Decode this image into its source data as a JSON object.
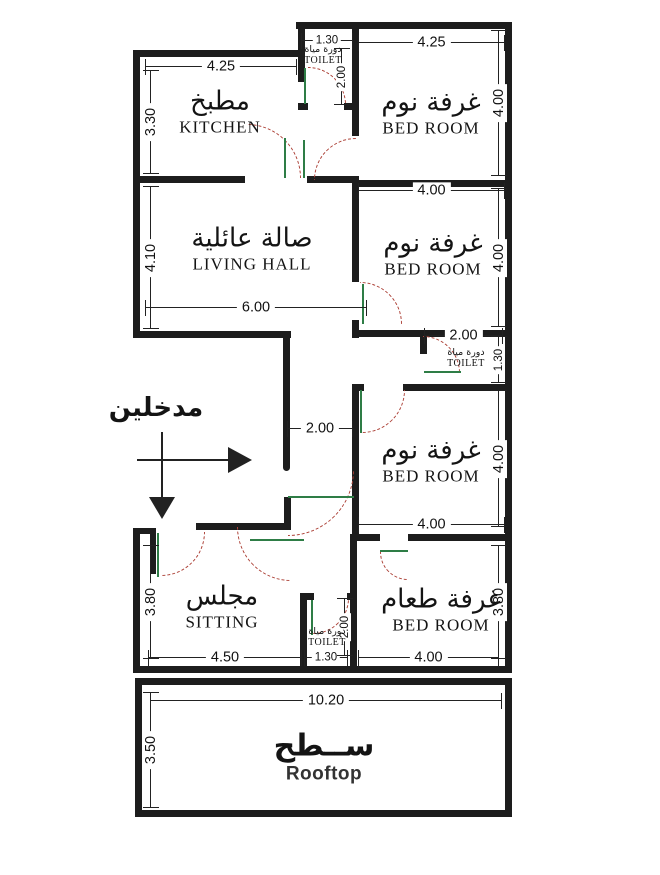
{
  "rooms": {
    "kitchen": {
      "ar": "مطبخ",
      "en": "KITCHEN"
    },
    "bedroom1": {
      "ar": "غرفة نوم",
      "en": "BED ROOM"
    },
    "toilet1": {
      "ar": "دورة مياة",
      "en": "TOILET"
    },
    "living": {
      "ar": "صالة عائلية",
      "en": "LIVING HALL"
    },
    "bedroom2": {
      "ar": "غرفة نوم",
      "en": "BED ROOM"
    },
    "toilet2": {
      "ar": "دورة مياة",
      "en": "TOILET"
    },
    "bedroom3": {
      "ar": "غرفة نوم",
      "en": "BED ROOM"
    },
    "sitting": {
      "ar": "مجلس",
      "en": "SITTING"
    },
    "toilet3": {
      "ar": "دورة مياة",
      "en": "TOILET"
    },
    "dining": {
      "ar": "غرفة طعام",
      "en": "BED ROOM"
    },
    "rooftop": {
      "ar": "ســطح",
      "en": "Rooftop"
    }
  },
  "entrance": {
    "label_ar": "مدخلين"
  },
  "dims": {
    "kitchen_width": "4.25",
    "kitchen_height": "3.30",
    "toilet1_width": "1.30",
    "toilet1_height": "2.00",
    "bedroom1_width": "4.25",
    "bedroom1_height": "4.00",
    "living_width": "6.00",
    "living_height": "4.10",
    "bedroom2_width": "4.00",
    "bedroom2_height": "4.00",
    "toilet2_width": "2.00",
    "toilet2_height": "1.30",
    "corridor_width": "2.00",
    "bedroom3_width": "4.00",
    "bedroom3_height": "4.00",
    "sitting_width": "4.50",
    "sitting_height": "3.80",
    "toilet3_width": "1.30",
    "toilet3_height": "2.00",
    "dining_width": "4.00",
    "dining_height": "3.80",
    "rooftop_width": "10.20",
    "rooftop_height": "3.50"
  },
  "colors": {
    "wall": "#1d1d1d",
    "door_arc": "#ad4238",
    "door_leaf": "#2e7d46",
    "dim_line": "#222222"
  }
}
